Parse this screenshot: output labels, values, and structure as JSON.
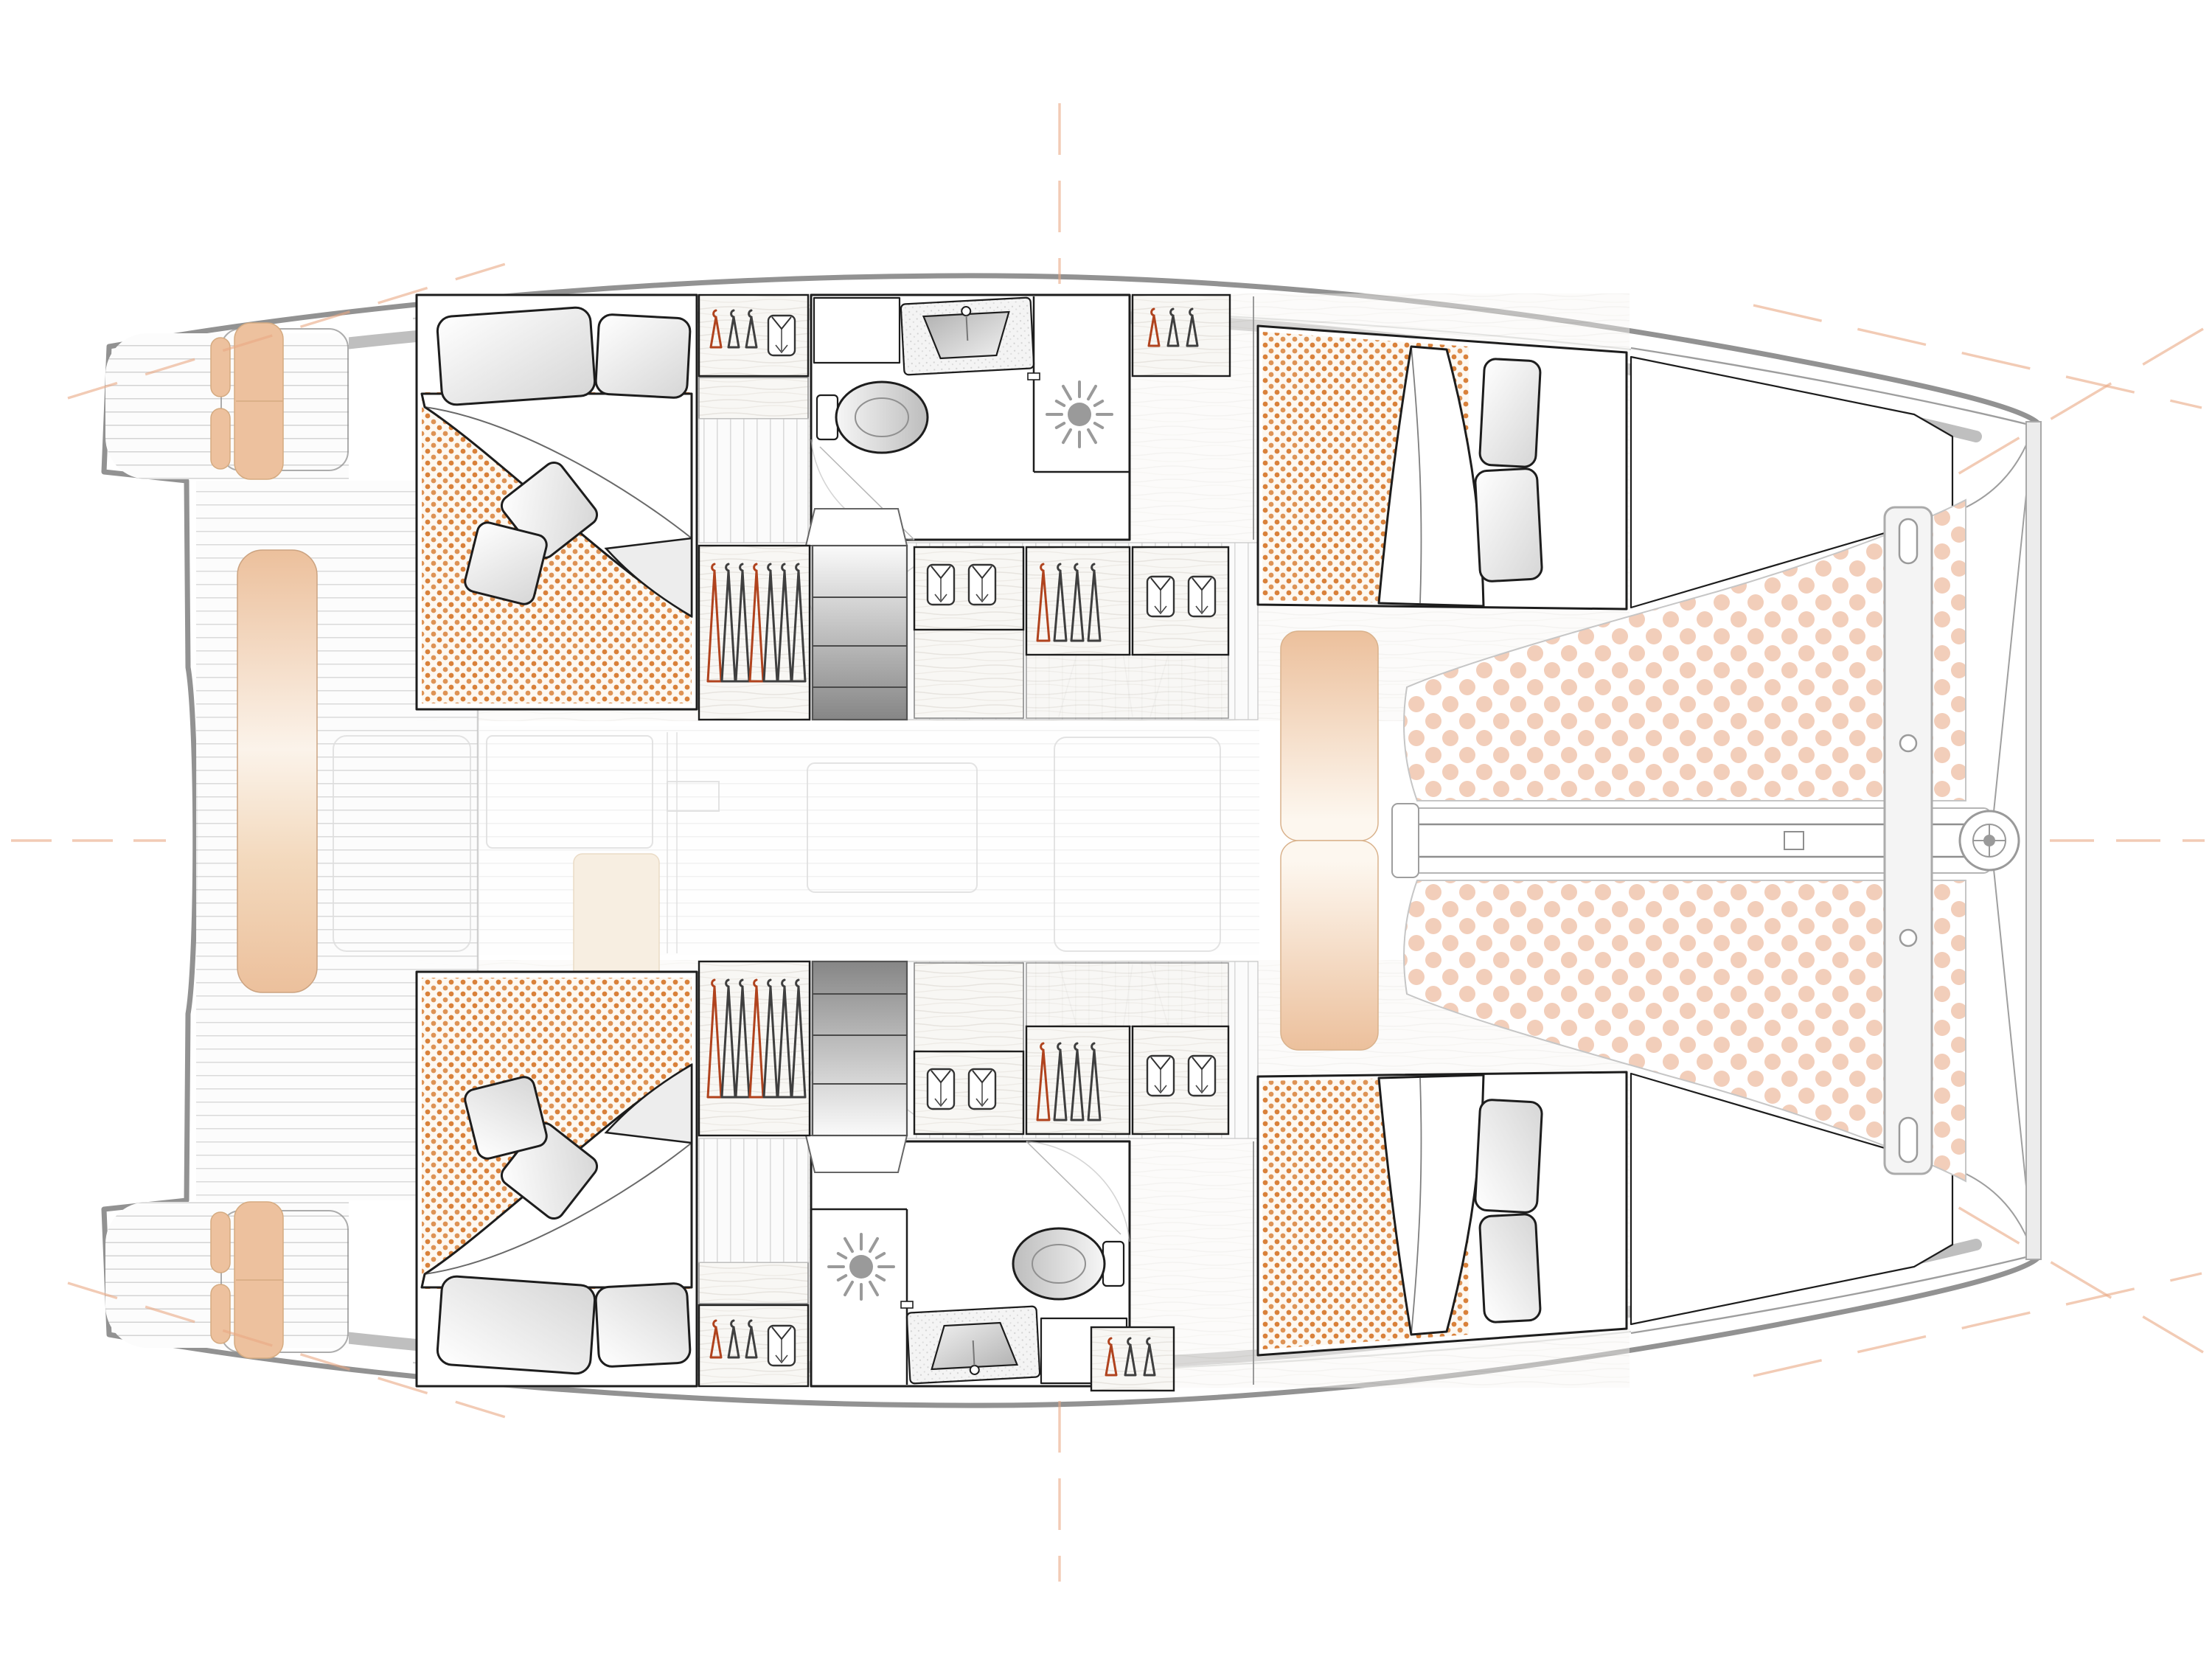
{
  "document": {
    "type": "boat-floor-plan",
    "subject": "catamaran interior and deck layout, top view",
    "orientation": {
      "bow": "right",
      "stern": "left"
    },
    "visible_text": ""
  },
  "colors": {
    "hull_line": "#929292",
    "band": "#bfbfbf",
    "ink": "#1d1d1d",
    "mattress_dot": "#d9813a",
    "mattress_bg": "#fdf8f1",
    "trampoline_dot": "#f2ceba",
    "cushion": "#edc19e",
    "cushion_edge": "#d5ab81",
    "hanger_red": "#b0431e",
    "hanger_gray": "#3f3f3f",
    "sun_gray": "#9a9a9a",
    "guide_orange": "#eaa883",
    "salon_beige": "#f7eee1"
  },
  "areas": {
    "stern": [
      "swim-platform-port",
      "swim-platform-starboard",
      "aft-cockpit",
      "helm-bench-cushion"
    ],
    "salon": "faint bridgedeck saloon (under roof, drawn ghosted)",
    "port_hull": [
      "aft-double-cabin",
      "wardrobes",
      "head-with-shower",
      "companionway-steps",
      "forward-double-cabin",
      "bow-locker"
    ],
    "starboard_hull": [
      "aft-double-cabin",
      "wardrobes",
      "head-with-shower",
      "companionway-steps",
      "forward-double-cabin",
      "bow-locker"
    ],
    "foredeck": [
      "lounge-cushion-port",
      "lounge-cushion-starboard",
      "trampoline-port",
      "trampoline-starboard",
      "bowsprit-with-furler",
      "forward-crossbeam"
    ]
  },
  "fixtures": {
    "cabins": 4,
    "heads": 2,
    "bed_mattress_pattern": "orange dotted",
    "bed_pillows_aft_cabin": 2,
    "bed_throw_pillows_aft_cabin": 2,
    "bed_pillows_forward_cabin": 2,
    "shower_icon": "sun-burst",
    "toilet_icon": "oval-bowl-with-tank",
    "sink_icon": "speckled-counter-with-basin"
  },
  "wardrobes": {
    "top_aft": {
      "hangers": [
        "red",
        "white",
        "white"
      ],
      "shirts": 1
    },
    "top_mid_hanging": {
      "hangers": [
        "red",
        "white",
        "white",
        "red",
        "white",
        "white",
        "white"
      ],
      "shirts": 0
    },
    "top_drawer_shirts": {
      "hangers": [],
      "shirts": 2
    },
    "top_hanging_2": {
      "hangers": [
        "red",
        "white",
        "white",
        "white"
      ],
      "shirts": 0
    },
    "top_shirts_2": {
      "hangers": [],
      "shirts": 2
    },
    "top_fwd_closet": {
      "hangers": [
        "red",
        "white",
        "white"
      ],
      "shirts": 0
    },
    "bottom_aft": {
      "hangers": [
        "red",
        "white",
        "white"
      ],
      "shirts": 1
    },
    "bottom_mid_hanging": {
      "hangers": [
        "red",
        "white",
        "white",
        "red",
        "white",
        "white",
        "white"
      ],
      "shirts": 0
    },
    "bottom_drawer_shirts": {
      "hangers": [],
      "shirts": 2
    },
    "bottom_hanging_2": {
      "hangers": [
        "red",
        "white",
        "white",
        "white"
      ],
      "shirts": 0
    },
    "bottom_shirts_2": {
      "hangers": [],
      "shirts": 2
    },
    "bottom_fwd_closet": {
      "hangers": [
        "red",
        "white",
        "white"
      ],
      "shirts": 0
    }
  },
  "guides": {
    "centerline_dashes": [
      "left",
      "right"
    ],
    "vertical_dashes": [
      "top-center",
      "bottom-center"
    ],
    "diagonal_dashes": [
      "stern-port",
      "stern-starboard",
      "bow-cross-port",
      "bow-cross-starboard"
    ]
  }
}
